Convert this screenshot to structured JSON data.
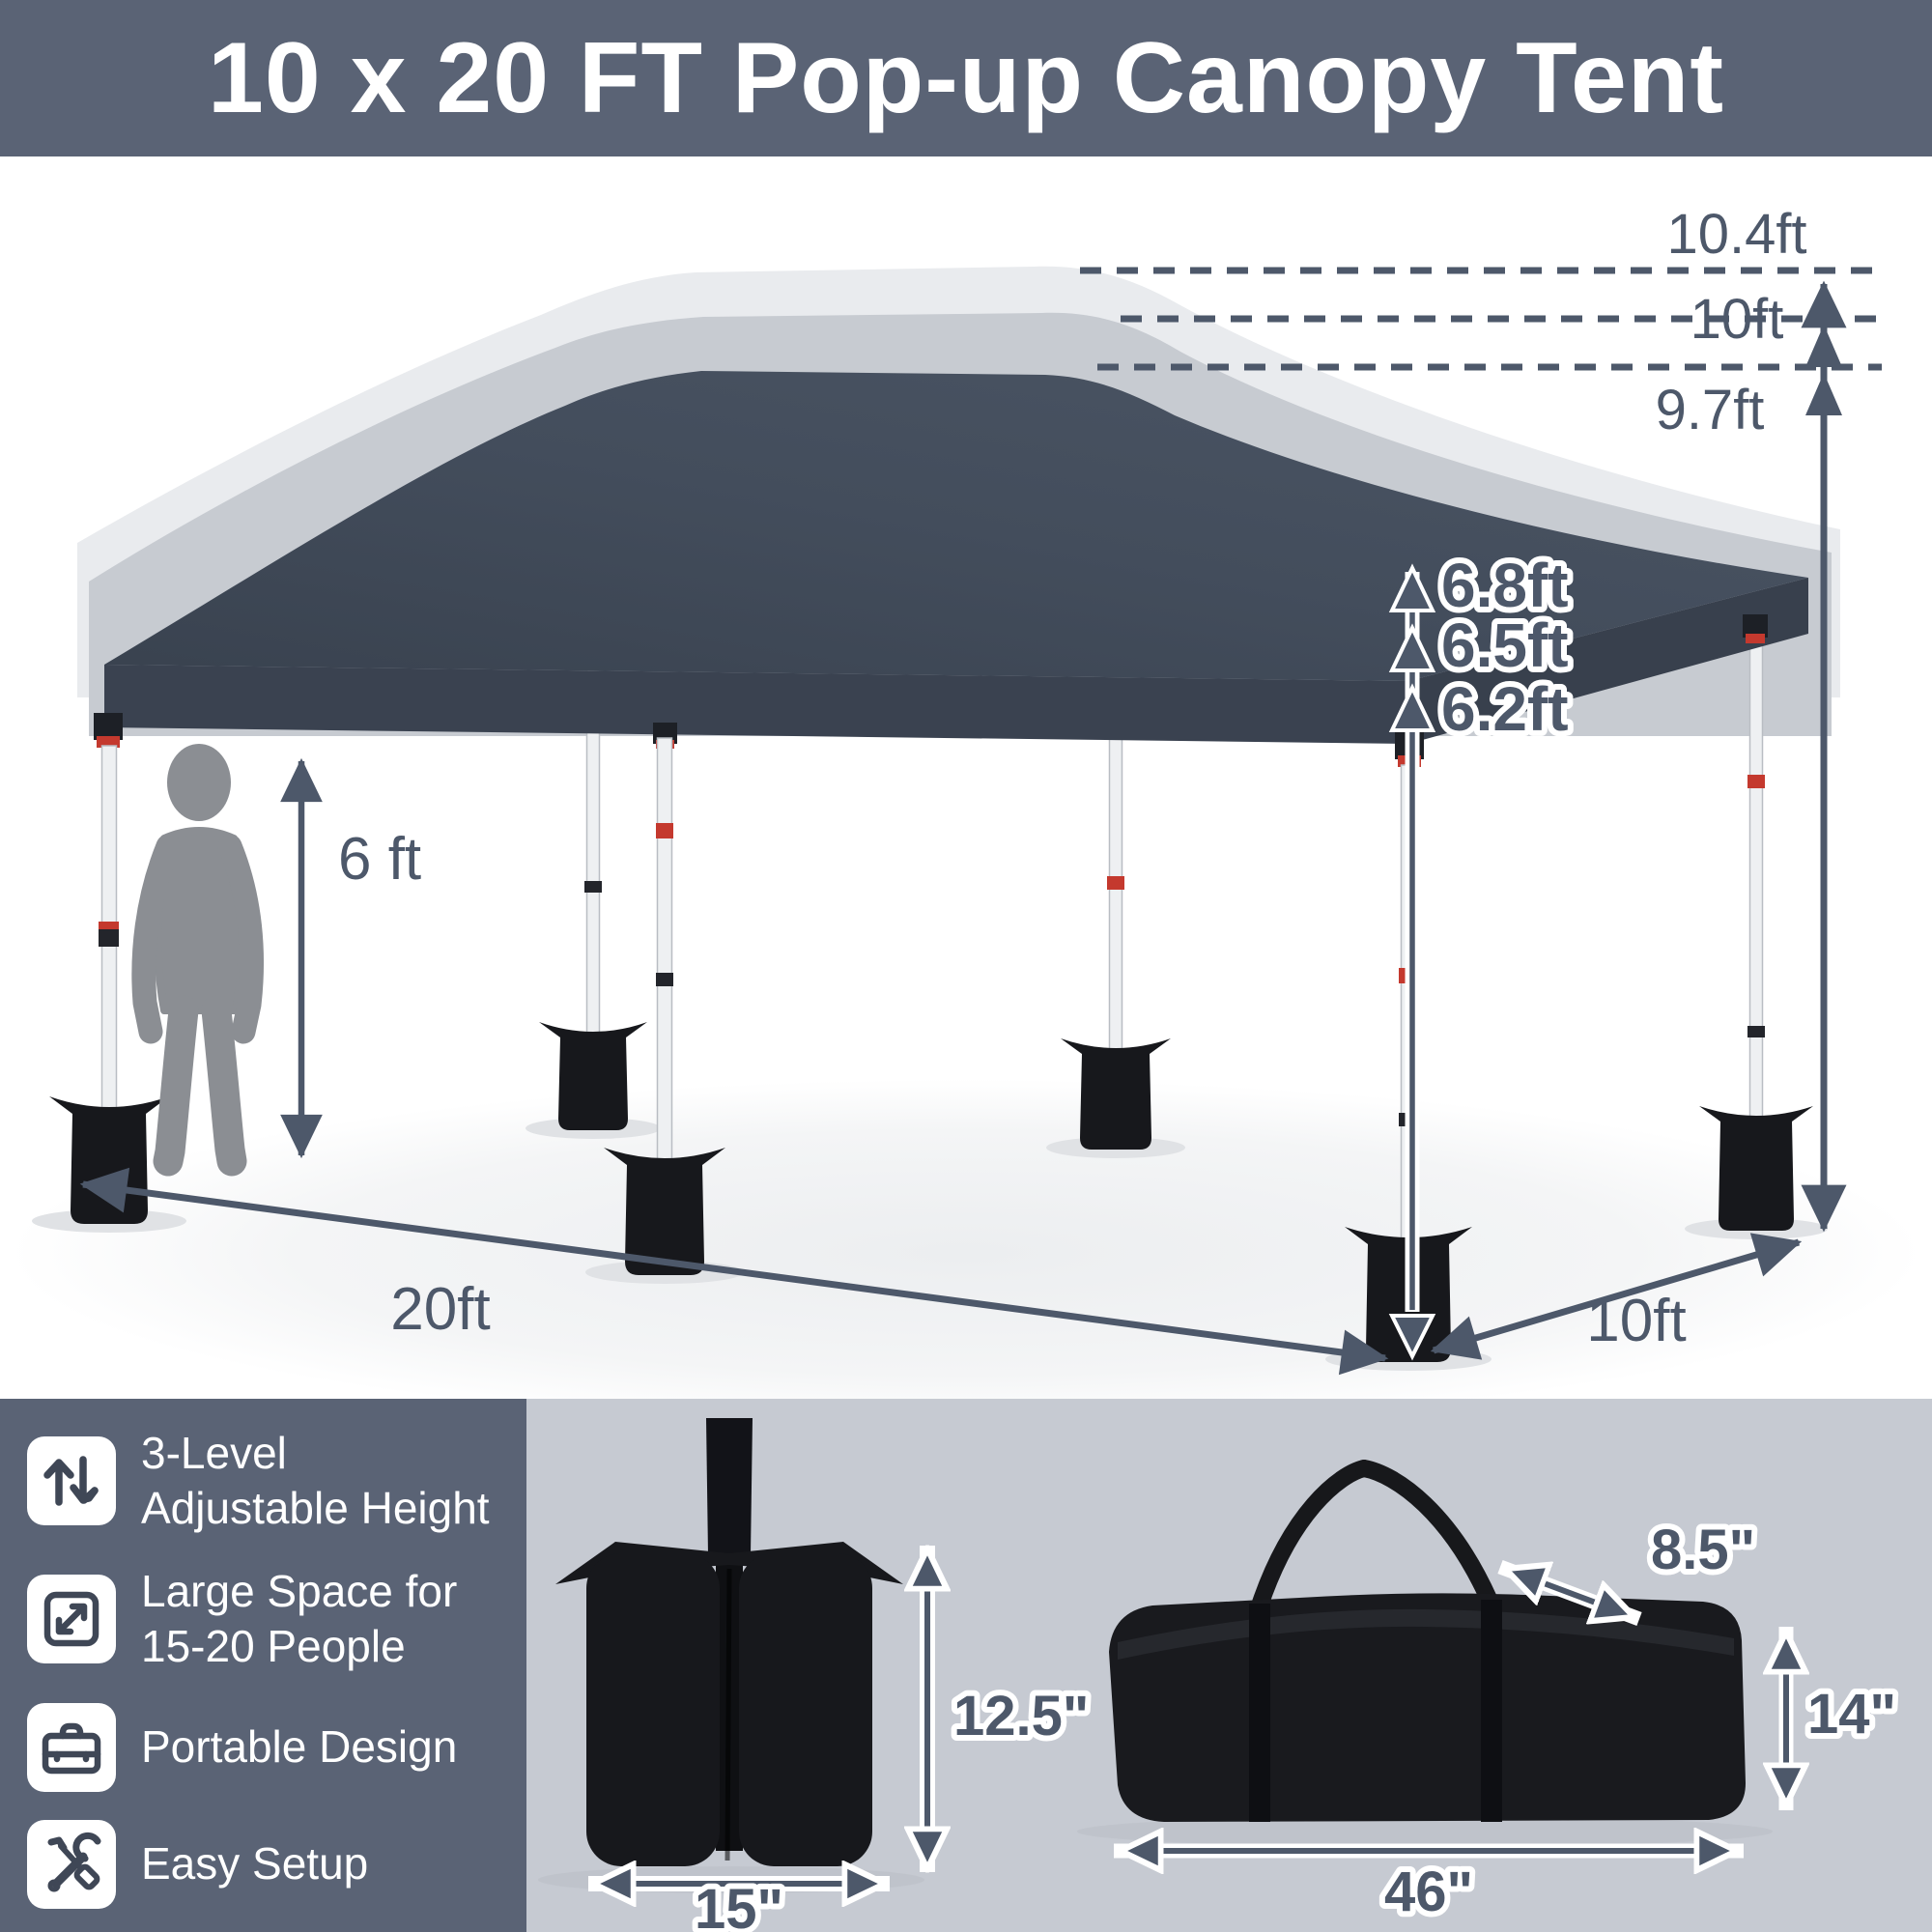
{
  "header": {
    "title": "10 x 20 FT Pop-up Canopy Tent"
  },
  "tent": {
    "peak_heights": {
      "raised": "10.4ft",
      "middle": "10ft",
      "lowered": "9.7ft"
    },
    "eave_heights": {
      "raised": "6.8ft",
      "middle": "6.5ft",
      "lowered": "6.2ft"
    },
    "person_height": "6 ft",
    "length": "20ft",
    "depth": "10ft"
  },
  "features": [
    {
      "icon": "height-adjust-icon",
      "line1": "3-Level",
      "line2": "Adjustable Height"
    },
    {
      "icon": "expand-icon",
      "line1": "Large Space for",
      "line2": "15-20 People"
    },
    {
      "icon": "briefcase-icon",
      "line1": "Portable Design",
      "line2": ""
    },
    {
      "icon": "tools-icon",
      "line1": "Easy Setup",
      "line2": ""
    }
  ],
  "sand_bag": {
    "height": "12.5\"",
    "width": "15\""
  },
  "carry_bag": {
    "depth": "8.5\"",
    "height": "14\"",
    "length": "46\""
  },
  "colors": {
    "banner": "#5a6375",
    "canopy": "#414b5b",
    "accent_red": "#c4392e",
    "panel": "#c6cad2",
    "dimension": "#4d586a"
  }
}
